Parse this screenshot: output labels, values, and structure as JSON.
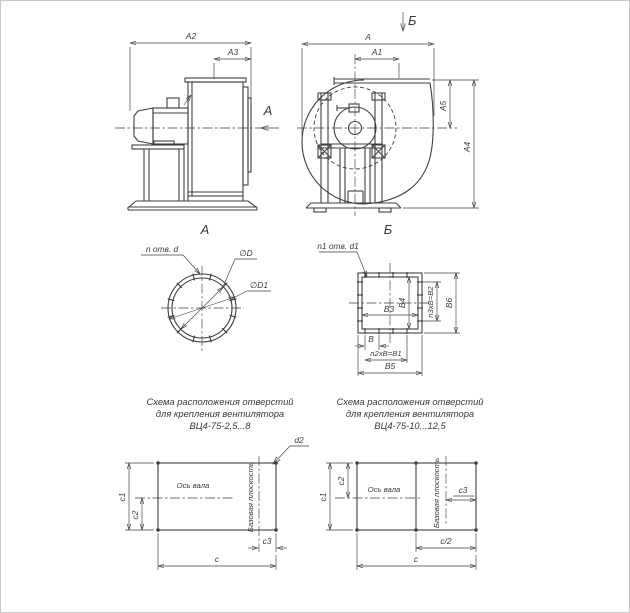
{
  "page": {
    "background": "#ffffff",
    "line_color": "#3f3f3f"
  },
  "side_view": {
    "dim_a2": "A2",
    "dim_a3": "A3",
    "view_arrow_label": "А"
  },
  "front_view": {
    "view_arrow_label": "Б",
    "dim_a": "A",
    "dim_a1": "A1",
    "dim_a5": "A5",
    "dim_a4": "A4"
  },
  "inlet_flange": {
    "title": "А",
    "holes_label": "n отв. d",
    "dia_inlet": "∅D",
    "dia_bolt_circle": "∅D1"
  },
  "outlet_flange": {
    "title": "Б",
    "holes_label": "n1 отв. d1",
    "dim_b": "B",
    "dim_b1": "n2xB=B1",
    "dim_b2": "n3xB=B2",
    "dim_b3": "B3",
    "dim_b4": "B4",
    "dim_b5": "B5",
    "dim_b6": "B6"
  },
  "mount_small": {
    "caption": [
      "Схема расположения отверстий",
      "для крепления вентилятора",
      "ВЦ4-75-2,5...8"
    ],
    "dim_d2": "d2",
    "dim_c1": "c1",
    "dim_c2": "c2",
    "dim_c3": "c3",
    "dim_c": "c",
    "axis_label": "Ось вала",
    "plane_label": "Базовая плоскость"
  },
  "mount_large": {
    "caption": [
      "Схема расположения отверстий",
      "для крепления вентилятора",
      "ВЦ4-75-10...12,5"
    ],
    "dim_c1": "c1",
    "dim_c2": "c2",
    "dim_c3": "c3",
    "dim_c_half": "c/2",
    "dim_c": "c",
    "axis_label": "Ось вала",
    "plane_label": "Базовая плоскость"
  }
}
